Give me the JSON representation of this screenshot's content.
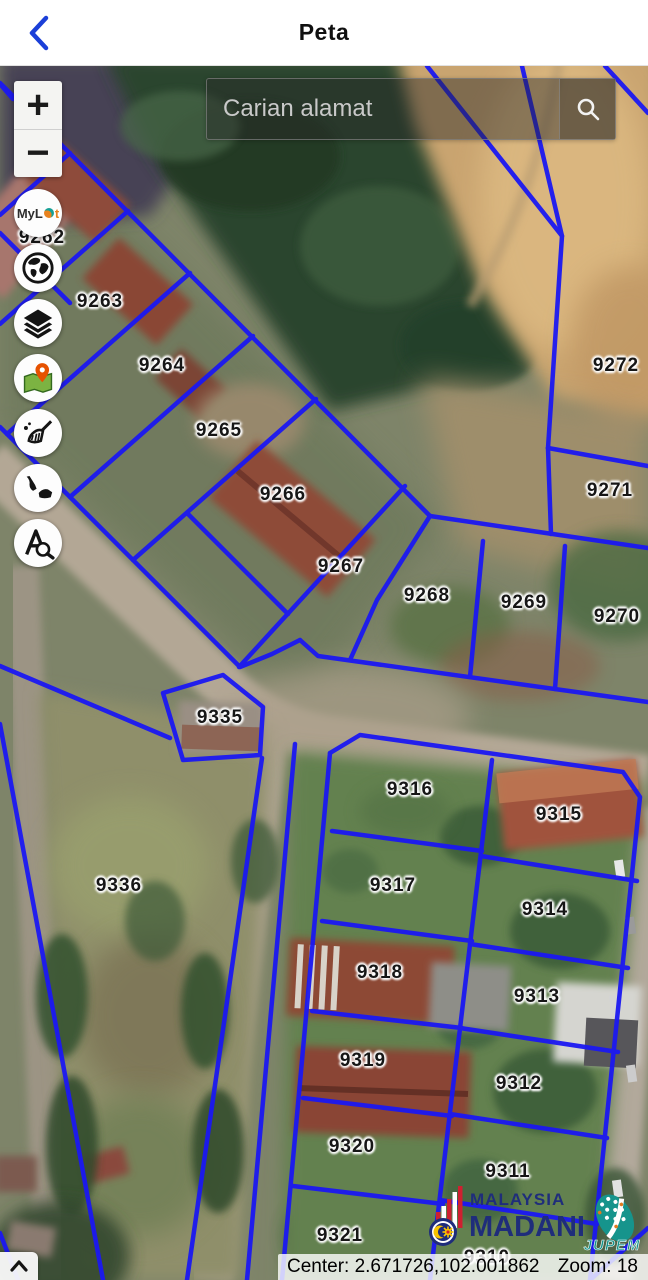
{
  "header": {
    "title": "Peta",
    "back_icon": "chevron-left"
  },
  "search": {
    "placeholder": "Carian alamat",
    "icon": "magnifier"
  },
  "zoom_control": {
    "zoom_in": "+",
    "zoom_out": "−"
  },
  "tools": [
    {
      "id": "mylot",
      "label_prefix": "My",
      "label_mid": "L",
      "label_suffix": "t",
      "icon": "mylot-logo"
    },
    {
      "id": "basemap",
      "icon": "globe-icon"
    },
    {
      "id": "layers",
      "icon": "layers-icon"
    },
    {
      "id": "locate",
      "icon": "map-marker-icon"
    },
    {
      "id": "clear",
      "icon": "broom-icon"
    },
    {
      "id": "malaysia",
      "icon": "malaysia-map-icon"
    },
    {
      "id": "text-search",
      "icon": "font-search-icon"
    }
  ],
  "map": {
    "type": "satellite-cadastral",
    "line_color": "#1b18f2",
    "parcels": [
      {
        "id": "9262",
        "x": 42,
        "y": 172
      },
      {
        "id": "9263",
        "x": 100,
        "y": 236
      },
      {
        "id": "9264",
        "x": 162,
        "y": 300
      },
      {
        "id": "9265",
        "x": 219,
        "y": 365
      },
      {
        "id": "9266",
        "x": 283,
        "y": 429
      },
      {
        "id": "9267",
        "x": 341,
        "y": 501
      },
      {
        "id": "9268",
        "x": 427,
        "y": 530
      },
      {
        "id": "9269",
        "x": 524,
        "y": 537
      },
      {
        "id": "9270",
        "x": 617,
        "y": 551
      },
      {
        "id": "9271",
        "x": 610,
        "y": 425
      },
      {
        "id": "9272",
        "x": 616,
        "y": 300
      },
      {
        "id": "9335",
        "x": 220,
        "y": 652
      },
      {
        "id": "9336",
        "x": 119,
        "y": 820
      },
      {
        "id": "9316",
        "x": 410,
        "y": 724
      },
      {
        "id": "9315",
        "x": 559,
        "y": 749
      },
      {
        "id": "9317",
        "x": 393,
        "y": 820
      },
      {
        "id": "9314",
        "x": 545,
        "y": 844
      },
      {
        "id": "9318",
        "x": 380,
        "y": 907
      },
      {
        "id": "9313",
        "x": 537,
        "y": 931
      },
      {
        "id": "9319",
        "x": 363,
        "y": 995
      },
      {
        "id": "9312",
        "x": 519,
        "y": 1018
      },
      {
        "id": "9320",
        "x": 352,
        "y": 1081
      },
      {
        "id": "9311",
        "x": 508,
        "y": 1106
      },
      {
        "id": "9321",
        "x": 340,
        "y": 1170
      },
      {
        "id": "9310",
        "x": 487,
        "y": 1192
      }
    ]
  },
  "status_bar": {
    "center": "Center: 2.671726,102.001862",
    "zoom": "Zoom: 18"
  },
  "branding": {
    "malaysia": "MALAYSIA",
    "madani": "MADANI",
    "jupem": "JUPEM",
    "navy": "#1f2d7b",
    "teal": "#16948c"
  },
  "expand_button": {
    "icon": "chevron-up"
  }
}
